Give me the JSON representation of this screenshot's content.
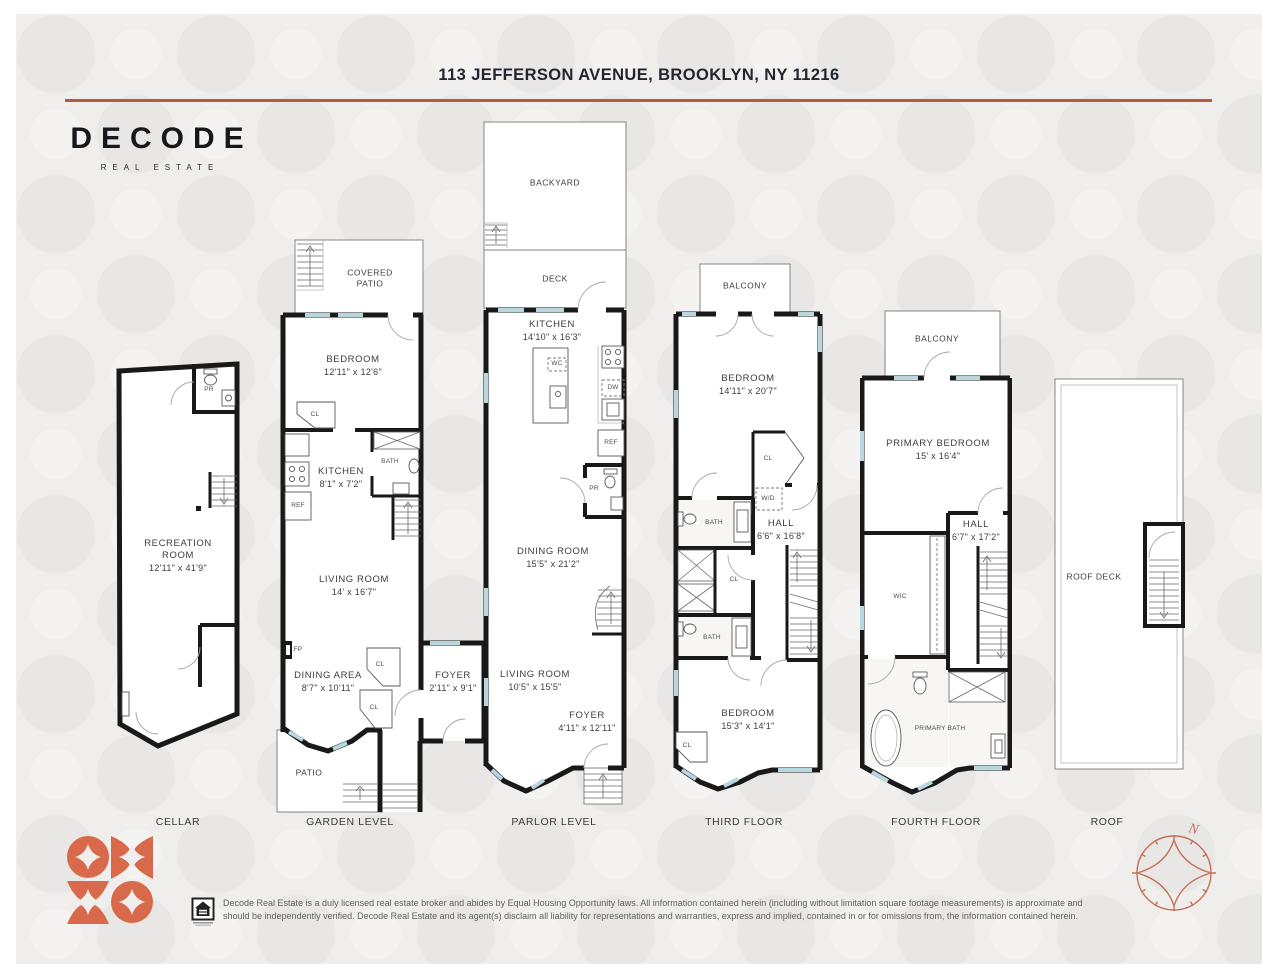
{
  "header": {
    "title": "113 JEFFERSON AVENUE, BROOKLYN, NY 11216"
  },
  "brand": {
    "wordmark": "DECODE",
    "tagline": "REAL ESTATE"
  },
  "colors": {
    "accent": "#b65a40",
    "logo_mark": "#d9694b",
    "walls": "#191919",
    "window": "#b7d6de"
  },
  "floors": {
    "cellar": {
      "label": "CELLAR",
      "rooms": {
        "recreation": {
          "name": "RECREATION ROOM",
          "dims": "12'11\" x 41'9\""
        },
        "powder": {
          "name": "PR"
        }
      }
    },
    "garden": {
      "label": "GARDEN LEVEL",
      "rooms": {
        "covered_patio": {
          "name": "COVERED PATIO"
        },
        "bedroom": {
          "name": "BEDROOM",
          "dims": "12'11\" x 12'6\""
        },
        "closet_a": {
          "name": "CL"
        },
        "kitchen": {
          "name": "KITCHEN",
          "dims": "8'1\" x 7'2\""
        },
        "fridge": {
          "name": "REF"
        },
        "bath": {
          "name": "BATH"
        },
        "living_room": {
          "name": "LIVING ROOM",
          "dims": "14' x 16'7\""
        },
        "fireplace": {
          "name": "FP"
        },
        "dining_area": {
          "name": "DINING AREA",
          "dims": "8'7\" x 10'11\""
        },
        "closet_b": {
          "name": "CL"
        },
        "closet_c": {
          "name": "CL"
        },
        "patio": {
          "name": "PATIO"
        },
        "foyer": {
          "name": "FOYER",
          "dims": "2'11\" x 9'1\""
        }
      }
    },
    "parlor": {
      "label": "PARLOR LEVEL",
      "rooms": {
        "backyard": {
          "name": "BACKYARD"
        },
        "deck": {
          "name": "DECK"
        },
        "kitchen": {
          "name": "KITCHEN",
          "dims": "14'10\" x 16'3\""
        },
        "wine_cooler": {
          "name": "WC"
        },
        "dishwasher": {
          "name": "DW"
        },
        "fridge": {
          "name": "REF"
        },
        "powder": {
          "name": "PR"
        },
        "dining_room": {
          "name": "DINING ROOM",
          "dims": "15'5\" x 21'2\""
        },
        "living_room": {
          "name": "LIVING ROOM",
          "dims": "10'5\" x 15'5\""
        },
        "foyer": {
          "name": "FOYER",
          "dims": "4'11\" x 12'11\""
        }
      }
    },
    "third": {
      "label": "THIRD FLOOR",
      "rooms": {
        "balcony": {
          "name": "BALCONY"
        },
        "bedroom_front": {
          "name": "BEDROOM",
          "dims": "14'11\" x 20'7\""
        },
        "closet_a": {
          "name": "CL"
        },
        "washer_dryer": {
          "name": "W/D"
        },
        "bath_a": {
          "name": "BATH"
        },
        "hall": {
          "name": "HALL",
          "dims": "6'6\" x 16'8\""
        },
        "closet_b": {
          "name": "CL"
        },
        "bath_b": {
          "name": "BATH"
        },
        "bedroom_rear": {
          "name": "BEDROOM",
          "dims": "15'3\" x 14'1\""
        },
        "closet_c": {
          "name": "CL"
        }
      }
    },
    "fourth": {
      "label": "FOURTH FLOOR",
      "rooms": {
        "balcony": {
          "name": "BALCONY"
        },
        "primary_bedroom": {
          "name": "PRIMARY BEDROOM",
          "dims": "15' x 16'4\""
        },
        "hall": {
          "name": "HALL",
          "dims": "6'7\" x 17'2\""
        },
        "walk_in_closet": {
          "name": "WIC"
        },
        "primary_bath": {
          "name": "PRIMARY BATH"
        }
      }
    },
    "roof": {
      "label": "ROOF",
      "rooms": {
        "roof_deck": {
          "name": "ROOF DECK"
        }
      }
    }
  },
  "compass": {
    "north": "N"
  },
  "footer": {
    "disclaimer": "Decode Real Estate is a duly licensed real estate broker and abides by Equal Housing Opportunity laws. All information contained herein (including without limitation square footage measurements) is approximate and should be independently verified. Decode Real Estate and its agent(s) disclaim all liability for representations and warranties, express and implied, contained in or for omissions from, the information contained herein."
  }
}
